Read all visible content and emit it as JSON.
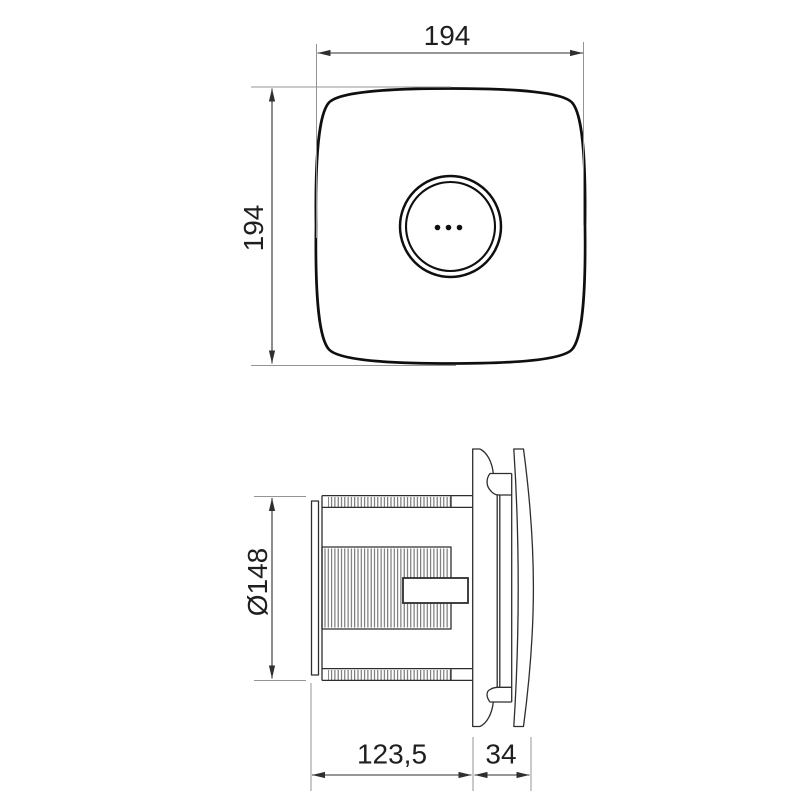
{
  "drawing": {
    "type": "technical-dimension-drawing",
    "subject": "square extractor fan, front and side elevations",
    "colors": {
      "background": "#ffffff",
      "outline": "#0f0f0f",
      "detail_line": "#2e2e2e",
      "extension_line": "#949494",
      "dimension_line": "#2f2f2f",
      "text": "#1f1f1f"
    },
    "front_view": {
      "name": "front view",
      "features": [
        "rounded-square cover",
        "concentric hub circles",
        "three vent dots"
      ],
      "width_dim": {
        "label": "194"
      },
      "height_dim": {
        "label": "194"
      }
    },
    "side_view": {
      "name": "side view",
      "features": [
        "back plate",
        "ribbed duct spigot",
        "clamp block",
        "wall flange",
        "bowed front cover"
      ],
      "diameter_dim": {
        "label": "Ø148"
      },
      "body_depth_dim": {
        "label": "123,5"
      },
      "cover_depth_dim": {
        "label": "34"
      }
    }
  }
}
